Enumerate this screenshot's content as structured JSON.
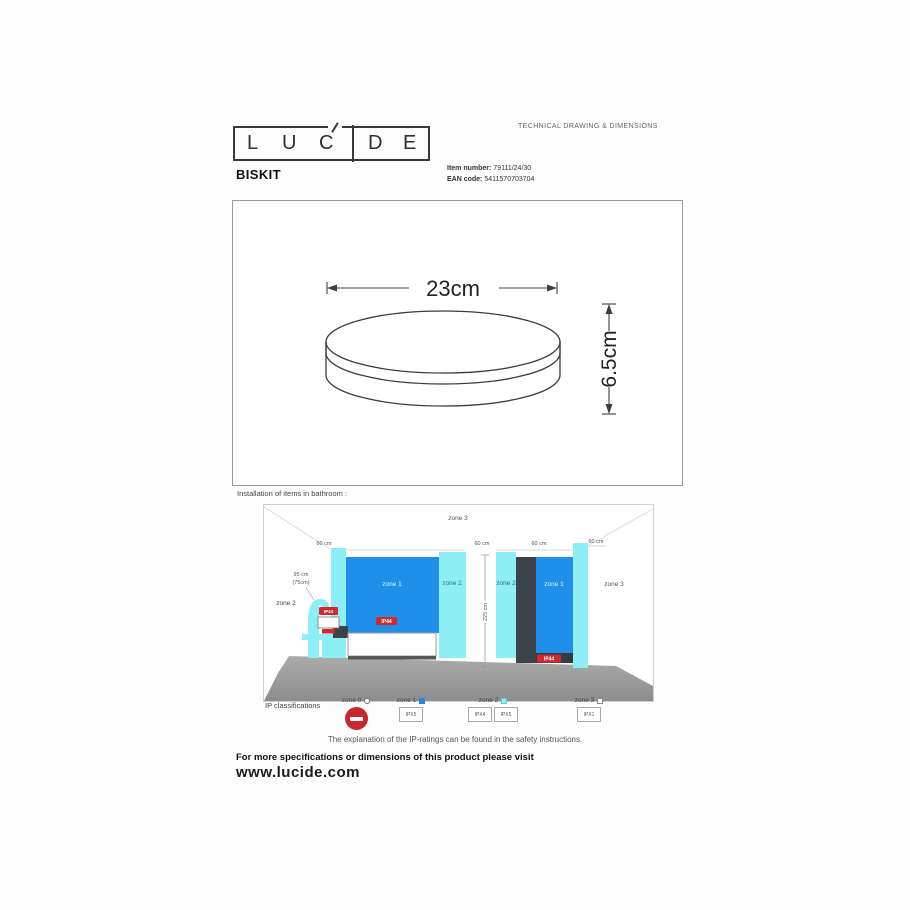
{
  "header": {
    "logo": {
      "letters": [
        "L",
        "U",
        "C",
        "D",
        "E"
      ]
    },
    "doc_type": "TECHNICAL DRAWING & DIMENSIONS"
  },
  "product": {
    "name": "BISKIT",
    "item_label": "Item number:",
    "item_number": "79111/24/30",
    "ean_label": "EAN code:",
    "ean_code": "5411570703704"
  },
  "drawing": {
    "width_dim": "23cm",
    "height_dim": "6.5cm"
  },
  "installation": {
    "heading": "Installation of items in bathroom :",
    "zone0": "zone 0",
    "zone1": "zone 1",
    "zone2": "zone 2",
    "zone3": "zone 3",
    "dim_60": "60 cm",
    "dim_225": "225 cm",
    "dim_95": "95 cm",
    "dim_75": "(75cm)",
    "ip_badge": "IP44",
    "legend": {
      "title": "IP classifications",
      "zones": [
        {
          "label": "zone 0",
          "ratings": []
        },
        {
          "label": "zone 1",
          "ratings": [
            "IPX5"
          ]
        },
        {
          "label": "zone 2",
          "ratings": [
            "IPX4",
            "IPX5"
          ]
        },
        {
          "label": "zone 3",
          "ratings": [
            "IPX1"
          ]
        }
      ]
    },
    "note": "The explanation of the IP-ratings can be found in the safety instructions."
  },
  "footer": {
    "visit_line": "For more specifications or dimensions of this product please visit",
    "website": "www.lucide.com"
  }
}
